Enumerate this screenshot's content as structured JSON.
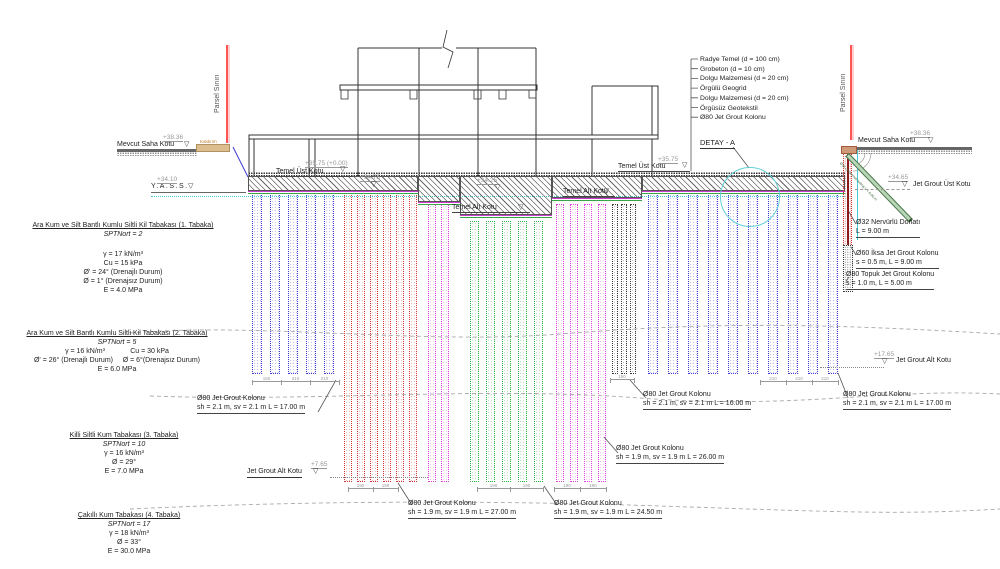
{
  "drawing": {
    "parcel_boundary_label": "Parsel Sınırı",
    "sidewalk_label": "Kaldırım",
    "detail_label": "DETAY - A",
    "legend": [
      "Radye Temel (d = 100 cm)",
      "Grobeton (d = 10 cm)",
      "Dolgu Malzemesi (d = 20 cm)",
      "Örgülü Geogrid",
      "Dolgu Malzemesi (d = 20 cm)",
      "Örgüsüz Geotekstil",
      "Ø80 Jet Grout Kolonu"
    ],
    "levels": {
      "mevcut_saha_left": {
        "label": "Mevcut Saha Kotu",
        "elev": "+38.36"
      },
      "mevcut_saha_right": {
        "label": "Mevcut Saha Kotu",
        "elev": "+38.36"
      },
      "yass": {
        "label": "Y.A.S.S.",
        "elev": "+34.10"
      },
      "temel_ust_left": {
        "label": "Temel Üst Kotu",
        "elev": "+35.75  (+0.00)"
      },
      "temel_ust_right": {
        "label": "Temel Üst Kotu",
        "elev": "+35.75"
      },
      "temel_alt_center": {
        "label": "Temel Alt Kotu"
      },
      "temel_alt_right": {
        "label": "Temel Alt Kotu"
      },
      "step_a": {
        "elev": "+34.75"
      },
      "step_b": {
        "elev": "+34.25"
      },
      "jet_grout_ust": {
        "label": "Jet Grout Üst Kotu",
        "elev": "+34.65"
      },
      "jet_grout_alt_right": {
        "label": "Jet Grout Alt Kotu",
        "elev": "+17.65"
      },
      "jet_grout_alt_left": {
        "label": "Jet Grout Alt Kotu",
        "elev": "+7.65"
      }
    },
    "soil_layers": [
      {
        "title": "Ara Kum ve Silt Bantlı Kumlu Siltli Kil Tabakası (1. Tabaka)",
        "spt": "SPTNort = 2",
        "props": [
          "γ = 17 kN/m³",
          "Cu = 15 kPa",
          "Ø' = 24° (Drenajlı Durum)",
          "Ø = 1°    (Drenajsız Durum)",
          "E = 4.0 MPa"
        ]
      },
      {
        "title": "Ara Kum ve Silt Bantlı Kumlu Siltli Kil Tabakası  (2. Tabaka)",
        "spt": "SPTNort = 5",
        "props": [
          "γ = 16 kN/m³             Cu = 30 kPa",
          "Ø' = 26° (Drenajlı Durum)     Ø = 6°(Drenajsız Durum)",
          "E = 6.0 MPa"
        ]
      },
      {
        "title": "Killi Siltli Kum Tabakası (3. Tabaka)",
        "spt": "SPTNort = 10",
        "props": [
          "γ = 16 kN/m³",
          "Ø = 29°",
          "E = 7.0 MPa"
        ]
      },
      {
        "title": "Çakıllı Kum Tabakası (4. Tabaka)",
        "spt": "SPTNort = 17",
        "props": [
          "γ = 18 kN/m³",
          "Ø = 33°",
          "E = 30.0 MPa"
        ]
      }
    ],
    "column_labels": [
      {
        "title": "Ø80 Jet Grout Kolonu",
        "spec": "sh = 2.1 m, sv = 2.1 m L = 17.00 m"
      },
      {
        "title": "Ø80 Jet Grout Kolonu",
        "spec": "sh = 2.1 m, sv = 2.1 m L = 16.00 m"
      },
      {
        "title": "Ø80 Jet Grout Kolonu",
        "spec": "sh = 2.1 m, sv = 2.1 m L = 17.00 m"
      },
      {
        "title": "Ø80 Jet Grout Kolonu",
        "spec": "sh = 1.9 m, sv = 1.9 m L = 26.00 m"
      },
      {
        "title": "Ø80 Jet Grout Kolonu",
        "spec": "sh = 1.9 m, sv = 1.9 m L = 27.00 m"
      },
      {
        "title": "Ø80 Jet Grout Kolonu",
        "spec": "sh = 1.9 m, sv = 1.9 m L = 24.50 m"
      }
    ],
    "wall_labels": [
      {
        "title": "Ø32 Nervürlü Donatı",
        "spec": "L = 9.00 m"
      },
      {
        "title": "Ø60 İksa Jet Grout Kolonu",
        "spec": "s = 0.5 m, L = 9.00 m"
      },
      {
        "title": "Ø80 Topuk Jet Grout Kolonu",
        "spec": "s = 1.0 m, L = 5.00 m"
      }
    ],
    "anchor_label": "Ø36 Öngermeli Ankraj  L = 8.00 m",
    "dims": {
      "left": [
        "150",
        "210",
        "210"
      ],
      "right": [
        "210",
        "210",
        "210"
      ],
      "black": [
        "150"
      ],
      "red": [
        "190",
        "190"
      ],
      "green": [
        "190",
        "190"
      ],
      "magenta": [
        "190",
        "190"
      ]
    },
    "colors": {
      "blue": "#3b3bd0",
      "red": "#d03030",
      "magenta": "#e040e0",
      "green": "#2fb84a",
      "black": "#3a3a3a",
      "cyan": "#45c8d0",
      "parcel": "#ff5555",
      "anchor": "#b9d6b9"
    }
  }
}
